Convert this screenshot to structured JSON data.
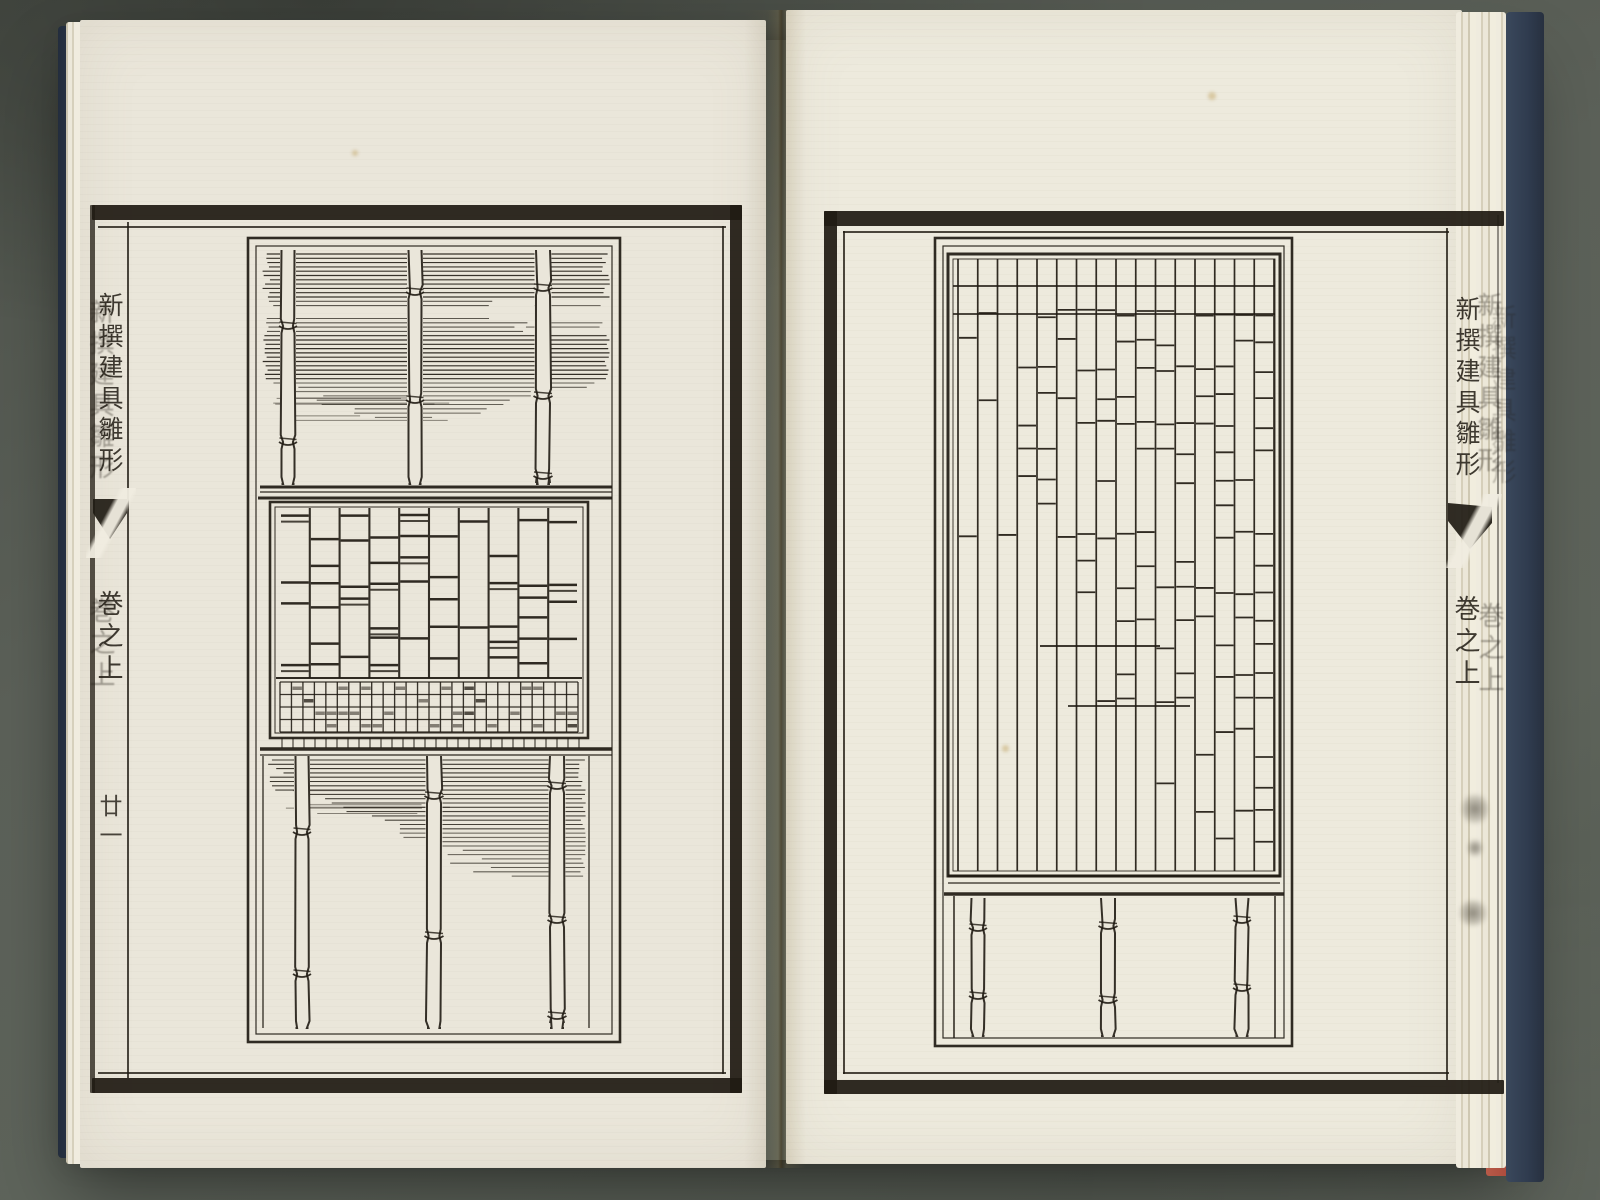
{
  "book": {
    "kind": "Edo-period woodblock-printed pattern book, open spread",
    "series_title": "新撰建具雛形",
    "volume_label": "巻之上",
    "left_page": {
      "folio_label": "廿一"
    },
    "colors": {
      "background": "#5c6159",
      "paper": "#eae6da",
      "paper2": "#edeadd",
      "ink": "#201b13",
      "cover_navy": "#2f3b4e",
      "cover_red": "#a8473a"
    }
  },
  "artwork": {
    "left_plate": {
      "description": "Bamboo screen design: hatched reed band with three bamboo posts above an irregular kumiko lattice panel with a fine square-grid base, and a lower hatched band with three bamboo posts",
      "top_bamboo_posts": 3,
      "bottom_bamboo_posts": 3,
      "lattice_columns": 10,
      "lattice_rows": 8,
      "fine_grid_columns": 26,
      "fine_grid_rows": 4
    },
    "right_plate": {
      "description": "Tall irregular lattice (midare-goshi) panel, denser toward the top right, over a rail with three bamboo posts",
      "lattice_columns": 16,
      "lattice_rows": 21,
      "bamboo_posts": 3
    }
  }
}
